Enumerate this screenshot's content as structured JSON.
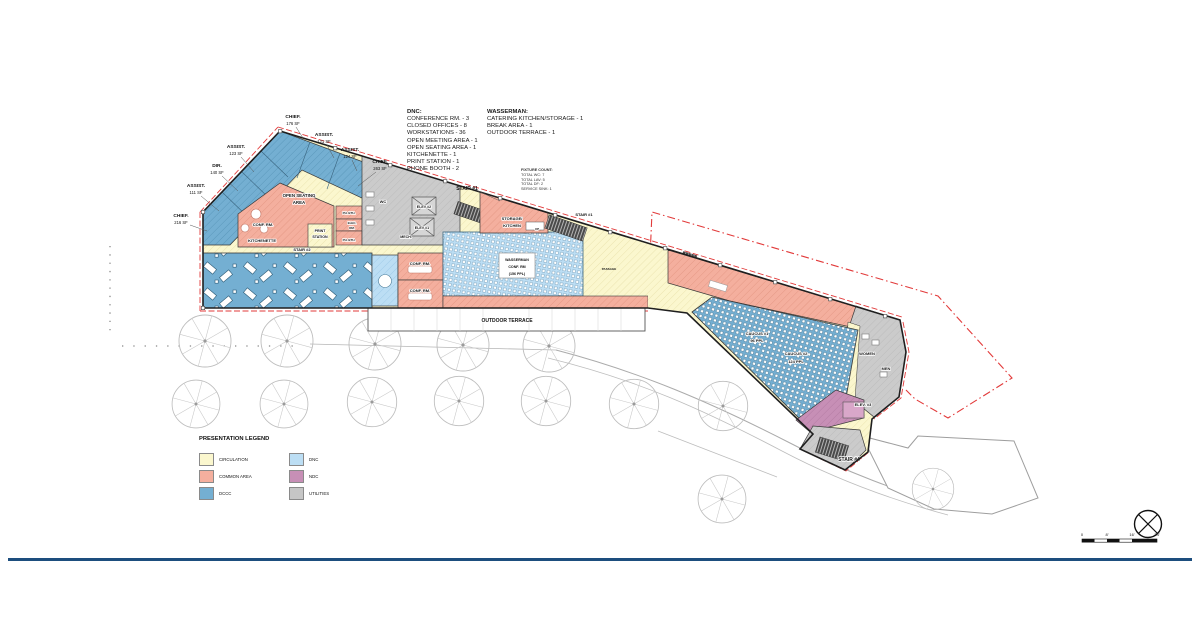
{
  "program_notes": {
    "dnc": {
      "heading": "DNC:",
      "items": [
        "CONFERENCE RM. - 3",
        "CLOSED OFFICES - 8",
        "WORKSTATIONS - 36",
        "OPEN MEETING AREA - 1",
        "OPEN SEATING AREA - 1",
        "KITCHENETTE - 1",
        "PRINT STATION - 1",
        "PHONE BOOTH - 2"
      ]
    },
    "wasserman": {
      "heading": "WASSERMAN:",
      "items": [
        "CATERING KITCHEN/STORAGE - 1",
        "BREAK AREA - 1",
        "OUTDOOR TERRACE - 1"
      ]
    },
    "fixture_count": {
      "heading": "FIXTURE COUNT:",
      "items": [
        "TOTAL WC: 7",
        "TOTAL LAV: 5",
        "TOTAL DF: 2",
        "SERVICE SINK: 1"
      ]
    }
  },
  "offices": [
    {
      "name": "CHIEF.",
      "area": "176 SF"
    },
    {
      "name": "ASSIST.",
      "area": "121 SF"
    },
    {
      "name": "ASSIST.",
      "area": "124 SF"
    },
    {
      "name": "CHIEF.",
      "area": "263 SF"
    },
    {
      "name": "ASSIST.",
      "area": "123 SF"
    },
    {
      "name": "DIR.",
      "area": "140 SF"
    },
    {
      "name": "ASSIST.",
      "area": "111 SF"
    },
    {
      "name": "CHIEF.",
      "area": "216 SF"
    }
  ],
  "rooms": {
    "open_seating_1": "OPEN SEATING",
    "open_seating_2": "AREA",
    "conf_rm": "CONF. RM.",
    "kitchenette": "KITCHENETTE",
    "print_1": "PRINT",
    "print_2": "STATION",
    "ph_bth_upper": "PH. BTH.",
    "elec_1": "ELEC.",
    "elec_2": "RM.",
    "ph_bth_lower": "PH. BTH.",
    "wc": "WC",
    "elev2": "ELEV #2",
    "elev1": "ELEV #1",
    "mech": "MECH.",
    "stair2": "STAIR #2",
    "stair1_outer": "STAIR #1",
    "stair1_inner": "STAIR #1",
    "storage_1": "STORAGE/",
    "storage_2": "KITCHEN",
    "up": "UP",
    "conf_upper": "CONF. RM.",
    "conf_lower": "CONF. RM.",
    "wasserman_1": "WASSERMAN",
    "wasserman_2": "CONF. RM",
    "wasserman_3": "(156 PPL)",
    "terrace": "OUTDOOR TERRACE",
    "passage": "PASSAGE",
    "caucus1_1": "CAUCUS #1",
    "caucus1_2": "96 PPL",
    "caucus2_1": "CAUCUS #2",
    "caucus2_2": "124 PPL",
    "women": "WOMEN",
    "men": "MEN",
    "elev3": "ELEV. #3",
    "stair4": "STAIR #4"
  },
  "legend": {
    "title": "PRESENTATION LEGEND",
    "items": [
      {
        "label": "CIRCULATION",
        "color": "#FBF7CE"
      },
      {
        "label": "COMMON AREA",
        "color": "#F4AF9E"
      },
      {
        "label": "DCCC",
        "color": "#74AFD2"
      },
      {
        "label": "DNC",
        "color": "#BCDEF4"
      },
      {
        "label": "NDC",
        "color": "#C78FB6"
      },
      {
        "label": "UTILITIES",
        "color": "#C6C6C6"
      }
    ]
  },
  "scale_bar": {
    "labels": [
      "0",
      "8'",
      "16'",
      "24'"
    ]
  }
}
